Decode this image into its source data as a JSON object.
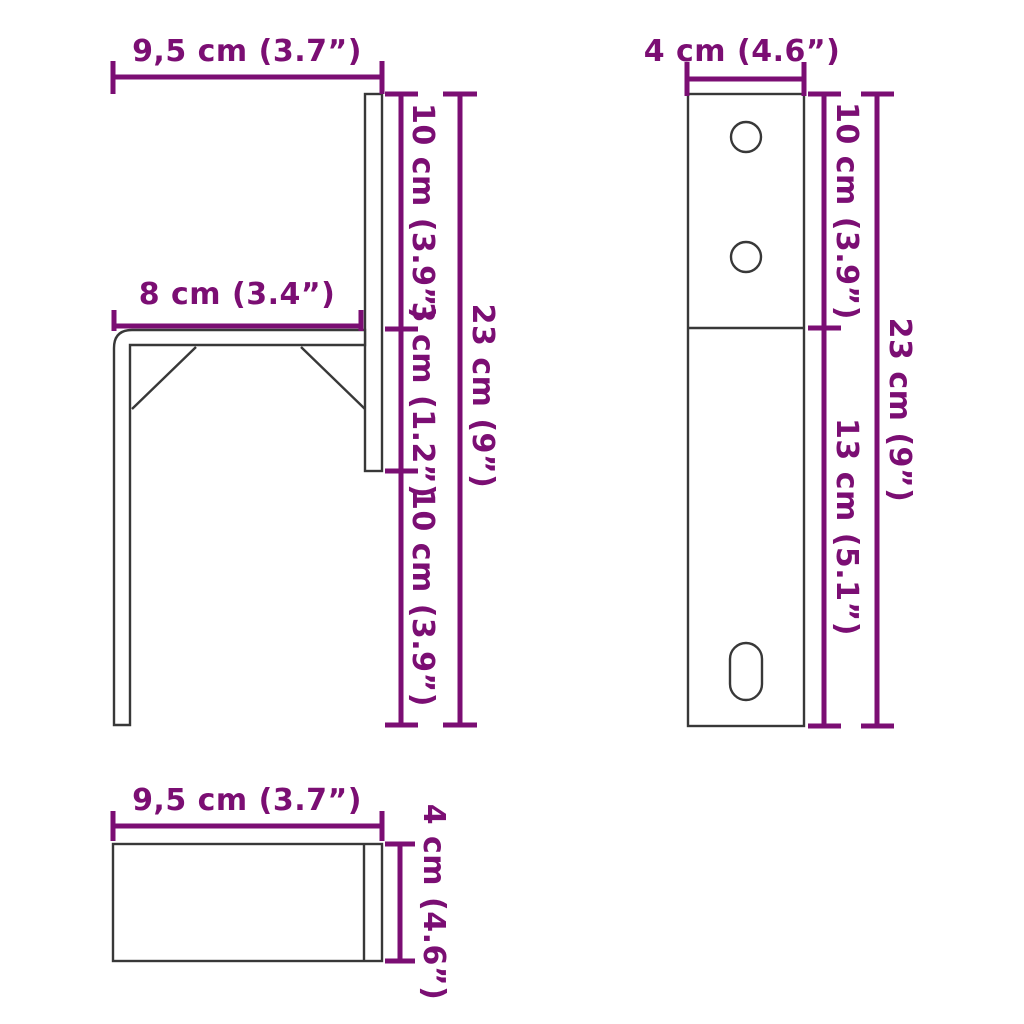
{
  "colors": {
    "dimension": "#7B0E73",
    "outline": "#383838",
    "background": "#ffffff"
  },
  "views": {
    "side": {
      "width": "9,5 cm (3.7”)",
      "arm": "8 cm (3.4”)",
      "upper": "10 cm (3.9”)",
      "middle": "3 cm (1.2”)",
      "lower": "10 cm (3.9”)",
      "total": "23 cm (9”)"
    },
    "front": {
      "width": "4 cm (4.6”)",
      "upper": "10 cm (3.9”)",
      "lower": "13 cm (5.1”)",
      "total": "23 cm (9”)"
    },
    "top": {
      "width": "9,5 cm (3.7”)",
      "depth": "4 cm (4.6”)"
    }
  }
}
